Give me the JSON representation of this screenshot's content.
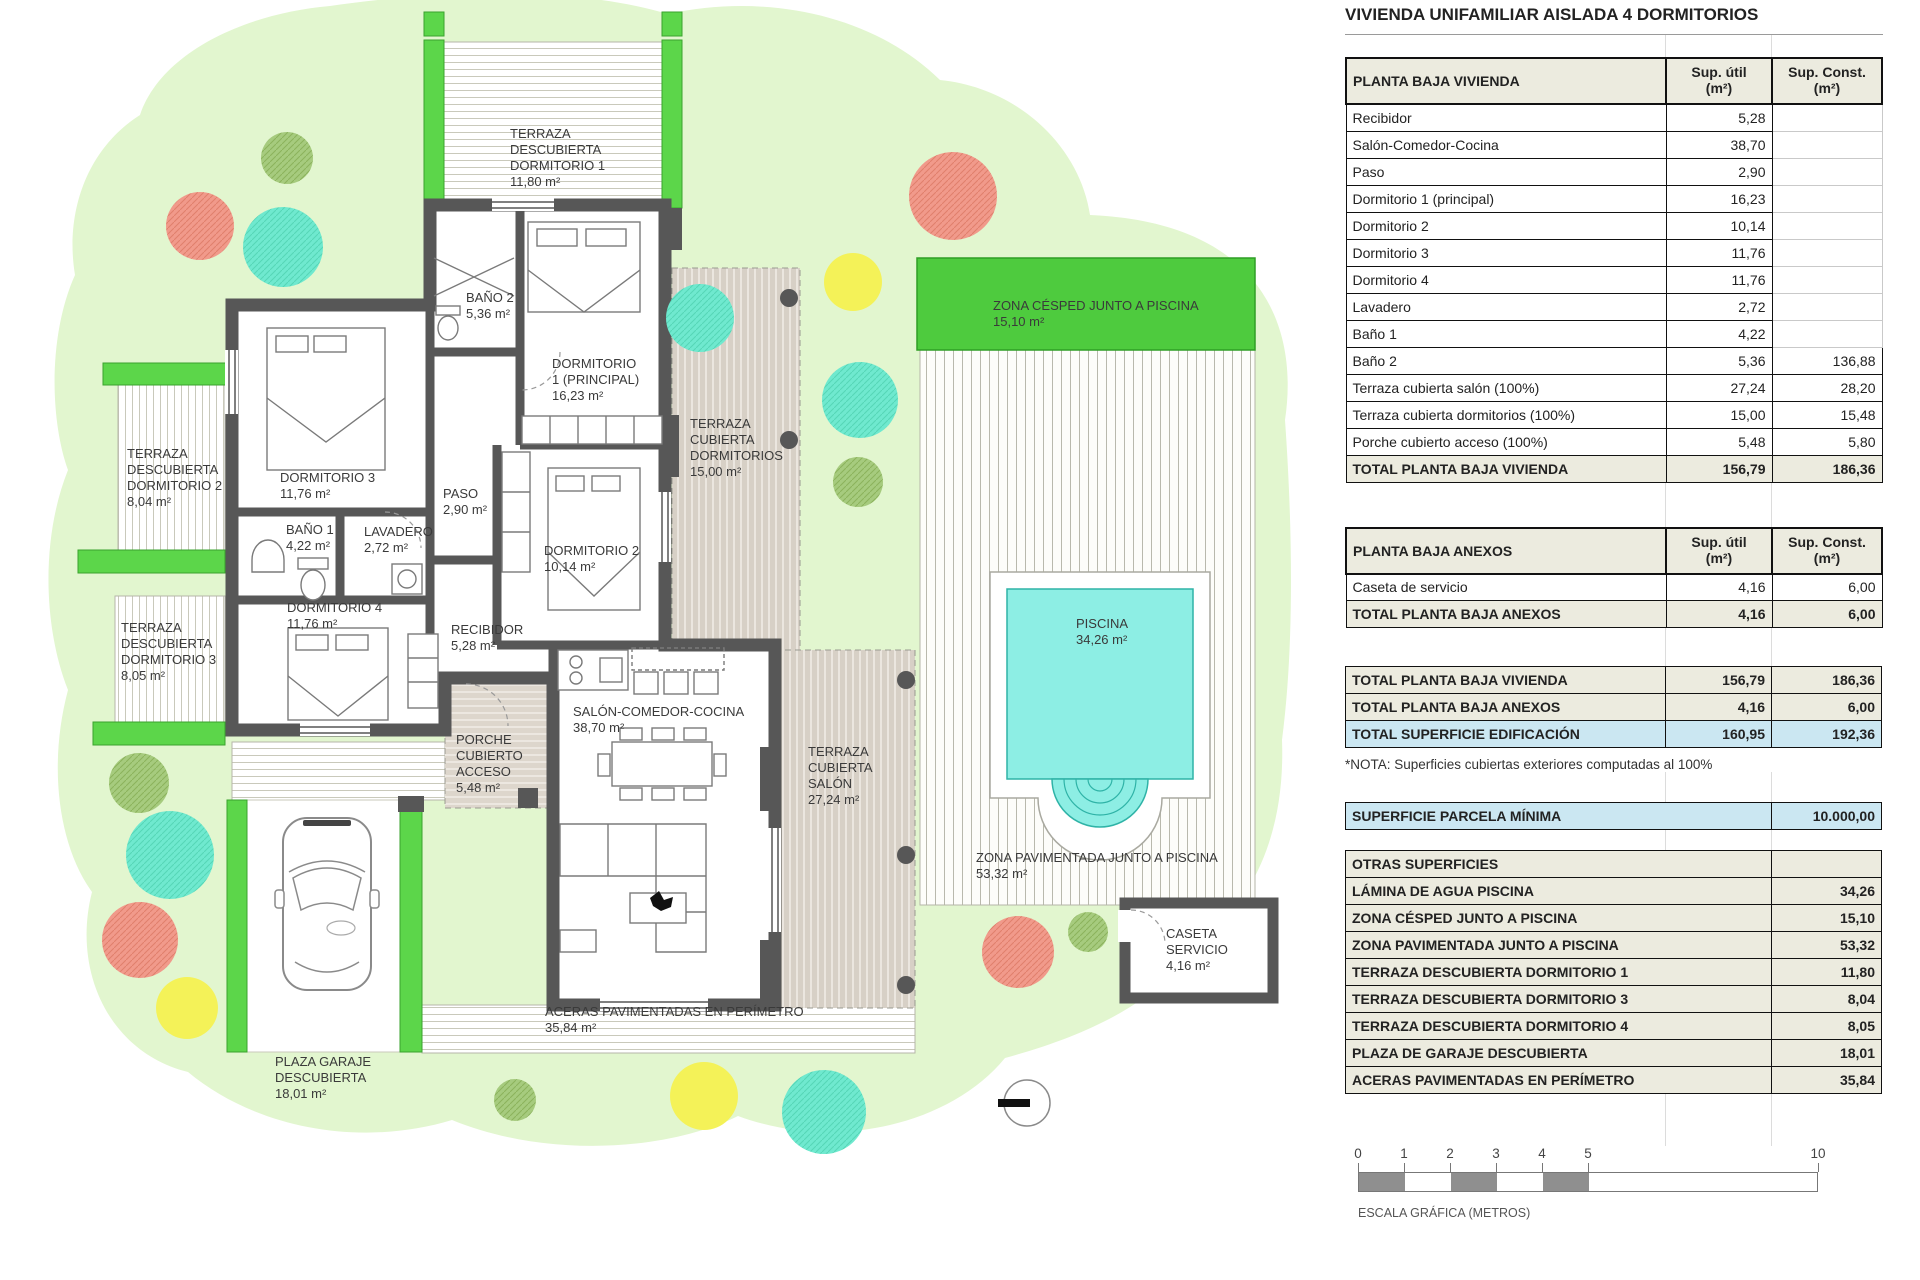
{
  "title": "VIVIENDA UNIFAMILIAR AISLADA 4 DORMITORIOS",
  "columns": {
    "util": "Sup. útil\n(m²)",
    "const": "Sup. Const.\n(m²)"
  },
  "vivienda": {
    "header": "PLANTA BAJA VIVIENDA",
    "rows": [
      {
        "label": "Recibidor",
        "util": "5,28",
        "const": ""
      },
      {
        "label": "Salón-Comedor-Cocina",
        "util": "38,70",
        "const": ""
      },
      {
        "label": "Paso",
        "util": "2,90",
        "const": ""
      },
      {
        "label": "Dormitorio 1 (principal)",
        "util": "16,23",
        "const": ""
      },
      {
        "label": "Dormitorio 2",
        "util": "10,14",
        "const": ""
      },
      {
        "label": "Dormitorio 3",
        "util": "11,76",
        "const": ""
      },
      {
        "label": "Dormitorio 4",
        "util": "11,76",
        "const": ""
      },
      {
        "label": "Lavadero",
        "util": "2,72",
        "const": ""
      },
      {
        "label": "Baño 1",
        "util": "4,22",
        "const": ""
      },
      {
        "label": "Baño 2",
        "util": "5,36",
        "const": "136,88"
      },
      {
        "label": "Terraza cubierta salón (100%)",
        "util": "27,24",
        "const": "28,20"
      },
      {
        "label": "Terraza cubierta dormitorios (100%)",
        "util": "15,00",
        "const": "15,48"
      },
      {
        "label": "Porche cubierto acceso (100%)",
        "util": "5,48",
        "const": "5,80"
      }
    ],
    "total": {
      "label": "TOTAL PLANTA BAJA VIVIENDA",
      "util": "156,79",
      "const": "186,36"
    }
  },
  "anexos": {
    "header": "PLANTA BAJA ANEXOS",
    "rows": [
      {
        "label": "Caseta de servicio",
        "util": "4,16",
        "const": "6,00"
      }
    ],
    "total": {
      "label": "TOTAL PLANTA BAJA ANEXOS",
      "util": "4,16",
      "const": "6,00"
    }
  },
  "resumen": {
    "rows": [
      {
        "label": "TOTAL PLANTA BAJA VIVIENDA",
        "util": "156,79",
        "const": "186,36"
      },
      {
        "label": "TOTAL PLANTA BAJA ANEXOS",
        "util": "4,16",
        "const": "6,00"
      }
    ],
    "total": {
      "label": "TOTAL SUPERFICIE EDIFICACIÓN",
      "util": "160,95",
      "const": "192,36"
    }
  },
  "nota": "*NOTA: Superficies cubiertas exteriores computadas al 100%",
  "parcela": {
    "label": "SUPERFICIE PARCELA MÍNIMA",
    "value": "10.000,00"
  },
  "otras": {
    "header": "OTRAS SUPERFICIES",
    "rows": [
      {
        "label": "LÁMINA DE AGUA PISCINA",
        "value": "34,26"
      },
      {
        "label": "ZONA CÉSPED JUNTO A PISCINA",
        "value": "15,10"
      },
      {
        "label": "ZONA PAVIMENTADA JUNTO A PISCINA",
        "value": "53,32"
      },
      {
        "label": "TERRAZA DESCUBIERTA DORMITORIO 1",
        "value": "11,80"
      },
      {
        "label": "TERRAZA DESCUBIERTA DORMITORIO 3",
        "value": "8,04"
      },
      {
        "label": "TERRAZA DESCUBIERTA DORMITORIO 4",
        "value": "8,05"
      },
      {
        "label": "PLAZA DE GARAJE DESCUBIERTA",
        "value": "18,01"
      },
      {
        "label": "ACERAS PAVIMENTADAS EN PERÍMETRO",
        "value": "35,84"
      }
    ]
  },
  "escala": {
    "ticks": [
      "0",
      "1",
      "2",
      "3",
      "4",
      "5",
      "10"
    ],
    "label": "ESCALA GRÁFICA (METROS)"
  },
  "palette": {
    "table_beige": "#ecebdf",
    "table_blue": "#cbe7f2",
    "lawn_light": "#e2f6cf",
    "planter_green": "#5cd64a",
    "cesped_green": "#4ecb3e",
    "pool_cyan": "#8deee4",
    "wall_gray": "#575757",
    "tree_salmon": "#f19a8b",
    "tree_teal": "#6fe9cf",
    "tree_yellow": "#f4f258",
    "tree_olive": "#a6cb7e"
  },
  "plan": {
    "labels": [
      {
        "id": "terraza-descubierta-dorm1",
        "text": "TERRAZA\nDESCUBIERTA\nDORMITORIO 1\n11,80 m²"
      },
      {
        "id": "bano2",
        "text": "BAÑO 2\n5,36 m²"
      },
      {
        "id": "dormitorio1",
        "text": "DORMITORIO\n1 (PRINCIPAL)\n16,23 m²"
      },
      {
        "id": "terraza-descubierta-dorm2",
        "text": "TERRAZA\nDESCUBIERTA\nDORMITORIO 2\n8,04 m²"
      },
      {
        "id": "dormitorio3",
        "text": "DORMITORIO 3\n11,76 m²"
      },
      {
        "id": "paso",
        "text": "PASO\n2,90 m²"
      },
      {
        "id": "bano1",
        "text": "BAÑO 1\n4,22 m²"
      },
      {
        "id": "lavadero",
        "text": "LAVADERO\n2,72 m²"
      },
      {
        "id": "dormitorio2",
        "text": "DORMITORIO 2\n10,14 m²"
      },
      {
        "id": "terraza-cubierta-dormitorios",
        "text": "TERRAZA\nCUBIERTA\nDORMITORIOS\n15,00 m²"
      },
      {
        "id": "zona-cesped",
        "text": "ZONA CÉSPED JUNTO A PISCINA\n15,10 m²"
      },
      {
        "id": "dormitorio4",
        "text": "DORMITORIO 4\n11,76 m²"
      },
      {
        "id": "terraza-descubierta-dorm3",
        "text": "TERRAZA\nDESCUBIERTA\nDORMITORIO 3\n8,05 m²"
      },
      {
        "id": "recibidor",
        "text": "RECIBIDOR\n5,28 m²"
      },
      {
        "id": "piscina",
        "text": "PISCINA\n34,26 m²"
      },
      {
        "id": "salon-comedor-cocina",
        "text": "SALÓN-COMEDOR-COCINA\n38,70 m²"
      },
      {
        "id": "porche-cubierto",
        "text": "PORCHE\nCUBIERTO\nACCESO\n5,48 m²"
      },
      {
        "id": "terraza-cubierta-salon",
        "text": "TERRAZA\nCUBIERTA\nSALÓN\n27,24 m²"
      },
      {
        "id": "zona-pavimentada",
        "text": "ZONA PAVIMENTADA JUNTO A PISCINA\n53,32 m²"
      },
      {
        "id": "caseta-servicio",
        "text": "CASETA\nSERVICIO\n4,16 m²"
      },
      {
        "id": "aceras",
        "text": "ACERAS PAVIMENTADAS EN PERÍMETRO\n35,84 m²"
      },
      {
        "id": "plaza-garaje",
        "text": "PLAZA GARAJE\nDESCUBIERTA\n18,01 m²"
      }
    ]
  }
}
